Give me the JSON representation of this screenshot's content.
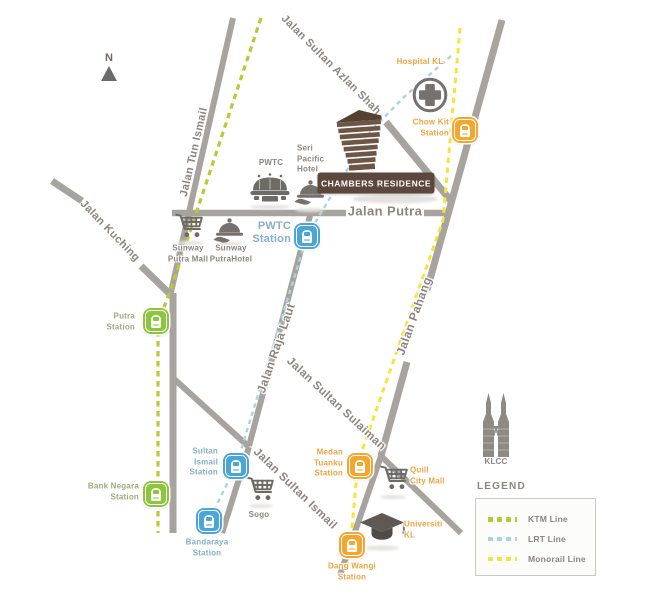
{
  "map": {
    "north_label": "N",
    "colors": {
      "road": "#a7a39f",
      "road_label": "#8b8580",
      "ktm_line": "#b9ca36",
      "lrt_line": "#a4d7df",
      "monorail_line": "#f6e43c",
      "ktm_station": "#8cc63e",
      "lrt_station": "#4aa5d8",
      "monorail_station": "#f4a72f",
      "landmark_icon": "#76716c",
      "chambers_brown": "#5b473b",
      "orange_text": "#eda43f",
      "green_text": "#9dab7d",
      "blue_text": "#85afc6"
    },
    "roads": [
      {
        "id": "jalan-tun-ismail",
        "points": [
          [
            233,
            18
          ],
          [
            171,
            292
          ]
        ],
        "width": 6
      },
      {
        "id": "jalan-kuching-west",
        "points": [
          [
            52,
            181
          ],
          [
            82,
            201
          ]
        ],
        "width": 7
      },
      {
        "id": "jalan-kuching-east",
        "points": [
          [
            141,
            266
          ],
          [
            174,
            298
          ]
        ],
        "width": 7
      },
      {
        "id": "jalan-kuching-south",
        "points": [
          [
            173,
            293
          ],
          [
            173,
            533
          ]
        ],
        "width": 7
      },
      {
        "id": "cross-branch",
        "points": [
          [
            172,
            377
          ],
          [
            249,
            447
          ]
        ],
        "width": 6
      },
      {
        "id": "branch-south",
        "points": [
          [
            249,
            447
          ],
          [
            222,
            533
          ]
        ],
        "width": 6
      },
      {
        "id": "jalan-raja-laut-road",
        "points": [
          [
            311,
            212
          ],
          [
            249,
            446
          ]
        ],
        "width": 6
      },
      {
        "id": "jalan-putra-west",
        "points": [
          [
            172,
            213
          ],
          [
            346,
            213
          ]
        ],
        "width": 6.5
      },
      {
        "id": "jalan-putra-east",
        "points": [
          [
            424,
            213
          ],
          [
            447,
            213
          ]
        ],
        "width": 6.5
      },
      {
        "id": "jalan-sultan-azlan-shah-road",
        "points": [
          [
            386,
            122
          ],
          [
            451,
            201
          ]
        ],
        "width": 7
      },
      {
        "id": "jalan-pahang-north",
        "points": [
          [
            502,
            20
          ],
          [
            427,
            290
          ]
        ],
        "width": 7
      },
      {
        "id": "jalan-pahang-south",
        "points": [
          [
            407,
            362
          ],
          [
            381,
            456
          ]
        ],
        "width": 7
      },
      {
        "id": "southeast-road",
        "points": [
          [
            381,
            456
          ],
          [
            461,
            533
          ]
        ],
        "width": 6
      },
      {
        "id": "dang-wangi-road",
        "points": [
          [
            381,
            456
          ],
          [
            340,
            575
          ]
        ],
        "width": 6
      }
    ],
    "road_labels": [
      {
        "id": "jalan-tun-ismail",
        "text": "Jalan Tun Ismail",
        "x": 194,
        "y": 152,
        "rotate": -77,
        "size": 11
      },
      {
        "id": "jalan-kuching",
        "text": "Jalan Kuching",
        "x": 110,
        "y": 231,
        "rotate": 46,
        "size": 11
      },
      {
        "id": "jalan-sultan-azlan-shah",
        "text": "Jalan Sultan Azlan Shah",
        "x": 331,
        "y": 65,
        "rotate": 45,
        "size": 11
      },
      {
        "id": "jalan-putra",
        "text": "Jalan Putra",
        "x": 385,
        "y": 211,
        "rotate": 0,
        "size": 13
      },
      {
        "id": "jalan-raja-laut",
        "text": "Jalan Raja Laut",
        "x": 276,
        "y": 348,
        "rotate": -71,
        "size": 12
      },
      {
        "id": "jalan-sultan-sulaiman",
        "text": "Jalan Sultan Sulaiman",
        "x": 336,
        "y": 404,
        "rotate": 43,
        "size": 11.5
      },
      {
        "id": "jalan-sultan-ismail",
        "text": "Jalan Sultan Ismail",
        "x": 295,
        "y": 489,
        "rotate": 44,
        "size": 11.5
      },
      {
        "id": "jalan-pahang",
        "text": "Jalan Pahang",
        "x": 414,
        "y": 316,
        "rotate": -70,
        "size": 12
      }
    ],
    "transit_lines": [
      {
        "id": "ktm-line",
        "name": "KTM Line",
        "color": "#b9ca36",
        "width": 3.2,
        "dash": "5.5,4.5",
        "points": [
          [
            261,
            18
          ],
          [
            171,
            289
          ],
          [
            158,
            323
          ],
          [
            158,
            533
          ]
        ]
      },
      {
        "id": "lrt-line",
        "name": "LRT Line",
        "color": "#a4d7df",
        "width": 2.4,
        "dash": "4.5,4",
        "points": [
          [
            451,
            56
          ],
          [
            404,
            97
          ],
          [
            370,
            132
          ],
          [
            307,
            236
          ],
          [
            236,
            466
          ],
          [
            209,
            520
          ]
        ]
      },
      {
        "id": "monorail-line",
        "name": "Monorail Line",
        "color": "#f6e43c",
        "width": 3,
        "dash": "5.5,4.5",
        "points": [
          [
            460,
            28
          ],
          [
            443,
            220
          ],
          [
            358,
            462
          ],
          [
            350,
            550
          ],
          [
            347,
            570
          ]
        ]
      }
    ],
    "stations": [
      {
        "id": "putra-station",
        "line": "ktm",
        "x": 156,
        "y": 321,
        "label": {
          "lines": [
            "Putra",
            "Station"
          ],
          "x": 135,
          "y": 322,
          "align": "right"
        }
      },
      {
        "id": "bank-negara-station",
        "line": "ktm",
        "x": 156,
        "y": 494,
        "label": {
          "lines": [
            "Bank Negara",
            "Station"
          ],
          "x": 139,
          "y": 492,
          "align": "right"
        }
      },
      {
        "id": "pwtc-station",
        "line": "lrt",
        "x": 307,
        "y": 236,
        "label": {
          "lines": [
            "PWTC",
            "Station"
          ],
          "x": 291,
          "y": 233,
          "align": "right",
          "size": 11
        }
      },
      {
        "id": "sultan-ismail-station",
        "line": "lrt",
        "x": 236,
        "y": 466,
        "label": {
          "lines": [
            "Sultan",
            "Ismail",
            "Station"
          ],
          "x": 218,
          "y": 462,
          "align": "right"
        }
      },
      {
        "id": "bandaraya-station",
        "line": "lrt",
        "x": 209,
        "y": 521,
        "label": {
          "lines": [
            "Bandaraya",
            "Station"
          ],
          "x": 207,
          "y": 548,
          "align": "center"
        }
      },
      {
        "id": "chow-kit-station",
        "line": "monorail",
        "x": 465,
        "y": 130,
        "label": {
          "lines": [
            "Chow Kit",
            "Station"
          ],
          "x": 449,
          "y": 128,
          "align": "right"
        }
      },
      {
        "id": "medan-tuanku-station",
        "line": "monorail",
        "x": 360,
        "y": 466,
        "label": {
          "lines": [
            "Medan",
            "Tuanku",
            "Station"
          ],
          "x": 343,
          "y": 463,
          "align": "right"
        }
      },
      {
        "id": "dang-wangi-station",
        "line": "monorail",
        "x": 352,
        "y": 545,
        "label": {
          "lines": [
            "Dang Wangi",
            "Station"
          ],
          "x": 352,
          "y": 572,
          "align": "center"
        }
      }
    ],
    "landmarks": [
      {
        "id": "hospital-kl",
        "icon": "cross",
        "x": 430,
        "y": 95,
        "label": {
          "lines": [
            "Hospital KL"
          ],
          "x": 420,
          "y": 62,
          "align": "center",
          "color": "orange"
        }
      },
      {
        "id": "pwtc",
        "icon": "arena",
        "x": 270,
        "y": 188,
        "label": {
          "lines": [
            "PWTC"
          ],
          "x": 271,
          "y": 163,
          "align": "center",
          "color": "gray"
        },
        "shadow": {
          "x": 270,
          "y": 207,
          "w": 40,
          "h": 4
        }
      },
      {
        "id": "seri-pacific-hotel",
        "icon": "cloche",
        "x": 310,
        "y": 193,
        "label": {
          "lines": [
            "Seri",
            "Pacific",
            "Hotel"
          ],
          "x": 297,
          "y": 159,
          "align": "left",
          "color": "gray"
        },
        "shadow": {
          "x": 310,
          "y": 210,
          "w": 30,
          "h": 4
        }
      },
      {
        "id": "sunway-putra-mall",
        "icon": "cart",
        "x": 190,
        "y": 226,
        "label": {
          "lines": [
            "Sunway",
            "Putra Mall"
          ],
          "x": 188,
          "y": 254,
          "align": "center",
          "color": "gray"
        },
        "shadow": {
          "x": 190,
          "y": 243,
          "w": 28,
          "h": 4
        }
      },
      {
        "id": "sunway-putra-hotel",
        "icon": "cloche",
        "x": 229,
        "y": 231,
        "label": {
          "lines": [
            "Sunway",
            "PutraHotel"
          ],
          "x": 231,
          "y": 254,
          "align": "center",
          "color": "gray"
        },
        "shadow": {
          "x": 229,
          "y": 244,
          "w": 28,
          "h": 4
        }
      },
      {
        "id": "sogo",
        "icon": "cart",
        "x": 261,
        "y": 489,
        "label": {
          "lines": [
            "Sogo"
          ],
          "x": 259,
          "y": 515,
          "align": "center",
          "color": "gray"
        },
        "shadow": {
          "x": 261,
          "y": 506,
          "w": 24,
          "h": 4
        }
      },
      {
        "id": "quill-city-mall",
        "icon": "cart",
        "x": 395,
        "y": 478,
        "label": {
          "lines": [
            "Quill",
            "City Mall"
          ],
          "x": 410,
          "y": 476,
          "align": "left",
          "color": "orange"
        },
        "shadow": {
          "x": 393,
          "y": 497,
          "w": 26,
          "h": 4
        }
      },
      {
        "id": "universiti-kl",
        "icon": "cap",
        "x": 382,
        "y": 528,
        "label": {
          "lines": [
            "Universiti",
            "KL"
          ],
          "x": 404,
          "y": 530,
          "align": "left",
          "color": "orange"
        },
        "shadow": {
          "x": 382,
          "y": 548,
          "w": 34,
          "h": 5
        }
      },
      {
        "id": "klcc",
        "icon": "towers",
        "x": 496,
        "y": 424,
        "label": {
          "lines": [
            "KLCC"
          ],
          "x": 496,
          "y": 462,
          "align": "center",
          "color": "gray"
        }
      }
    ],
    "chambers": {
      "id": "chambers-residence",
      "icon": "building",
      "x": 360,
      "y": 139,
      "box_label": {
        "text": "CHAMBERS RESIDENCE",
        "x": 376,
        "y": 183,
        "w": 117,
        "h": 21
      },
      "shadow": {
        "x": 395,
        "y": 199,
        "w": 86,
        "h": 9
      }
    },
    "legend": {
      "title": "LEGEND",
      "items": [
        {
          "id": "ktm-line",
          "label": "KTM Line",
          "color": "#b9ca36",
          "thickness": 5
        },
        {
          "id": "lrt-line",
          "label": "LRT Line",
          "color": "#a4d7df",
          "thickness": 3.5
        },
        {
          "id": "monorail-line",
          "label": "Monorail Line",
          "color": "#f6e43c",
          "thickness": 4.5
        }
      ]
    }
  }
}
